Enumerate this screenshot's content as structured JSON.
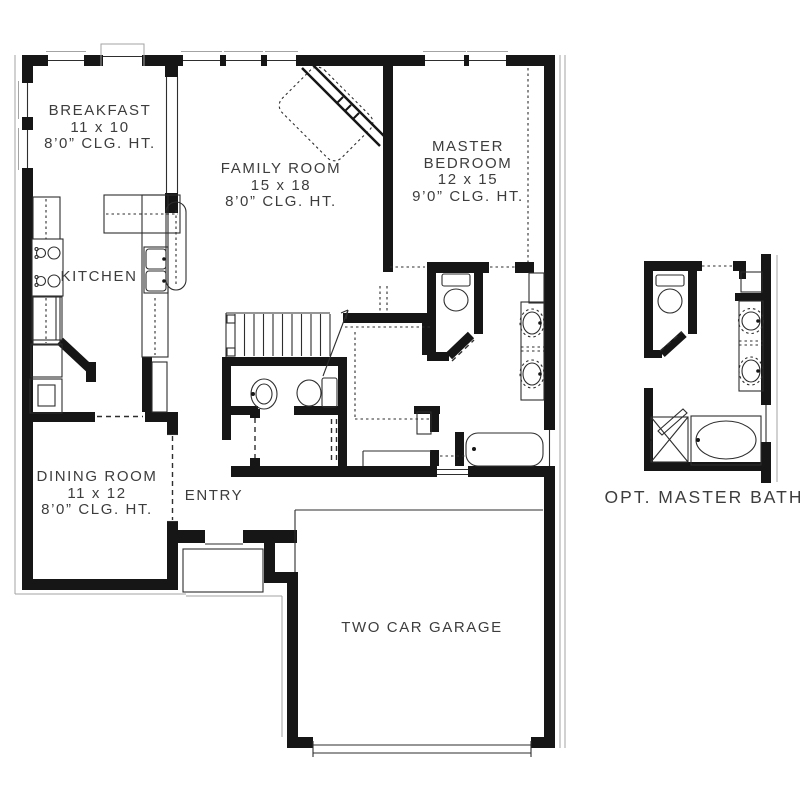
{
  "rooms": {
    "breakfast": {
      "name": "BREAKFAST",
      "dimensions": "11 x 10",
      "ceiling": "8’0” CLG. HT."
    },
    "family_room": {
      "name": "FAMILY ROOM",
      "dimensions": "15 x 18",
      "ceiling": "8’0” CLG. HT."
    },
    "master_bedroom": {
      "name_line1": "MASTER",
      "name_line2": "BEDROOM",
      "dimensions": "12 x 15",
      "ceiling": "9’0” CLG. HT."
    },
    "kitchen": {
      "name": "KITCHEN"
    },
    "dining_room": {
      "name": "DINING ROOM",
      "dimensions": "11 x 12",
      "ceiling": "8’0” CLG. HT."
    },
    "entry": {
      "name": "ENTRY"
    },
    "garage": {
      "name": "TWO CAR GARAGE"
    },
    "opt_master_bath": {
      "name": "OPT. MASTER BATH"
    }
  },
  "colors": {
    "wall": "#161616",
    "line": "#2e2e2e",
    "offset_line": "#a3a3a3",
    "text": "#3d3d3d",
    "background": "#ffffff"
  }
}
